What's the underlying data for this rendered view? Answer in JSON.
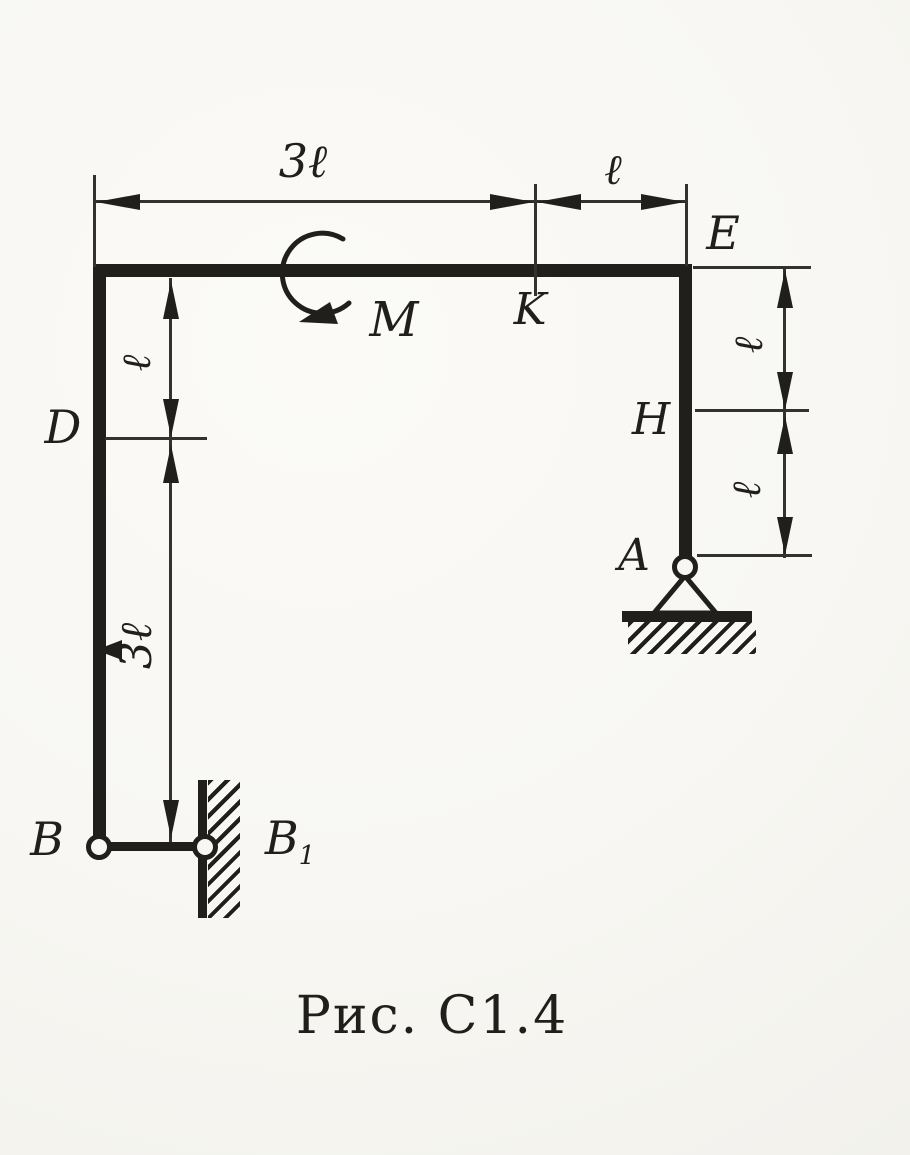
{
  "figure": {
    "caption": "Рис. С1.4",
    "labels": {
      "moment": "M",
      "point_k": "K",
      "point_e": "E",
      "point_d": "D",
      "point_h": "H",
      "point_a": "A",
      "point_b": "B",
      "point_b1_base": "B",
      "point_b1_sub": "1"
    },
    "dimensions": {
      "top_span": "3ℓ",
      "top_right_span": "ℓ",
      "left_upper_span": "ℓ",
      "left_lower_span": "3ℓ",
      "right_upper_span": "ℓ",
      "right_lower_span": "ℓ"
    },
    "colors": {
      "ink": "#211f1c",
      "paper": "#f8f7f3"
    }
  }
}
